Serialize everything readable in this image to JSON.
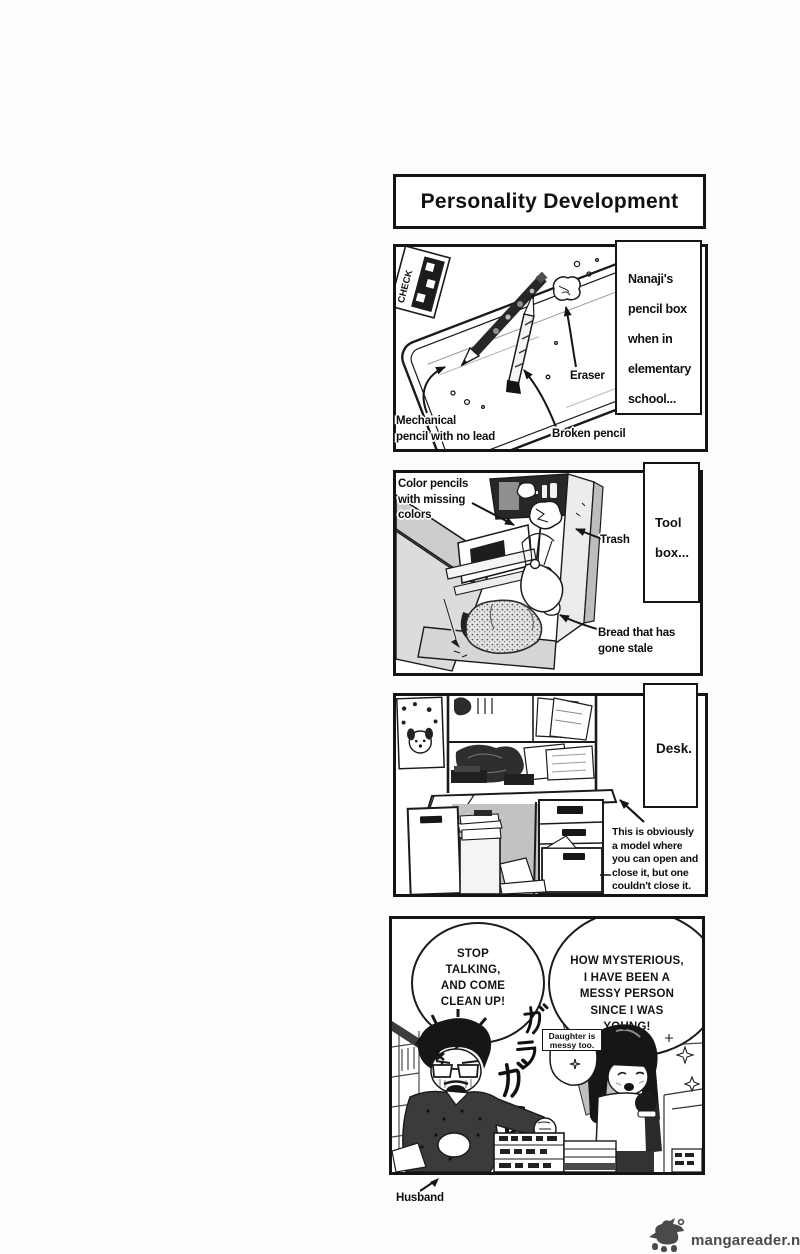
{
  "palette": {
    "ink": "#141414",
    "paper": "#ffffff",
    "watermark_gray": "#4a4a4a"
  },
  "title": "Personality Development",
  "watermark": "mangareader.net",
  "panel_pencil_box": {
    "caption_lines": [
      "Nanaji's",
      "pencil box",
      "when in",
      "elementary",
      "school..."
    ],
    "card_text": "CHECK",
    "label_mechanical_lines": [
      "Mechanical",
      "pencil with no lead"
    ],
    "label_broken": "Broken pencil",
    "label_eraser": "Eraser"
  },
  "panel_tool_box": {
    "caption_lines": [
      "Tool",
      "box..."
    ],
    "label_color_pencils_lines": [
      "Color pencils",
      "with missing",
      "colors"
    ],
    "label_trash": "Trash",
    "label_bread_lines": [
      "Bread that has",
      "gone stale"
    ]
  },
  "panel_desk": {
    "caption": "Desk.",
    "note_lines": [
      "This is obviously",
      "a model where",
      "you can open and",
      "close it, but one",
      "couldn't close it."
    ]
  },
  "panel_family": {
    "bubble_left_lines": [
      "STOP",
      "TALKING,",
      "AND COME",
      "CLEAN UP!"
    ],
    "bubble_right_lines": [
      "HOW MYSTERIOUS,",
      "I HAVE BEEN A",
      "MESSY PERSON",
      "SINCE I WAS",
      "YOUNG!"
    ],
    "daughter_tag_lines": [
      "Daughter is",
      "messy too."
    ],
    "sfx_katakana": "ガラガラ",
    "label_husband": "Husband"
  }
}
